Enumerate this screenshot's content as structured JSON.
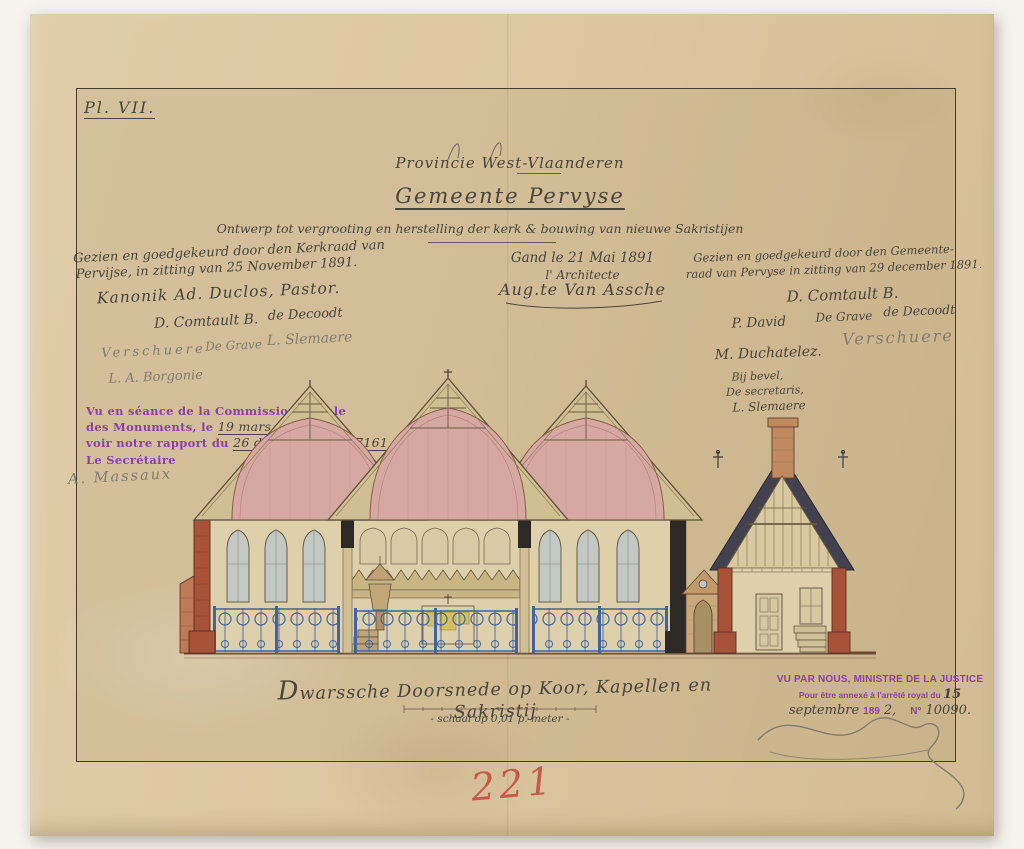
{
  "palette": {
    "bg": "#f6f4ef",
    "paper": "#dcc7a1",
    "frame": "#453c30",
    "ink": "#4a443a",
    "pencil": "#837b6d",
    "purple": "#8b3fa8",
    "red": "#c6483c",
    "brick": "#a9523a",
    "brick2": "#bc7a55",
    "slate": "#42414f",
    "blue": "#3f63a4",
    "pink": "#d6a8a2",
    "timber": "#d0bf92",
    "cream": "#ddd0ab",
    "glass": "#c2c8c4",
    "gold": "#d2be52",
    "dark": "#2d2a25",
    "line": "#5f5138",
    "ground": "#6b4a32"
  },
  "plate": {
    "label": "Pl. VII."
  },
  "header": {
    "province": "Provincie West-Vlaanderen",
    "gemeente": "Gemeente Pervyse",
    "subtitle": "Ontwerp tot vergrooting en herstelling der kerk & bouwing van nieuwe Sakristijen"
  },
  "church_approval": {
    "line1": "Gezien en goedgekeurd door den Kerkraad van",
    "line2": "Pervijse, in zitting van 25 November 1891.",
    "pastor": "Kanonik Ad. Duclos, Pastor.",
    "sig_row1a": "D. Comtault B.",
    "sig_row1b": "de Decoodt",
    "sig_row2a": "Verschuere",
    "sig_row2b": "De Grave",
    "sig_row2c": "L. Slemaere",
    "sig_row3": "L. A. Borgonie"
  },
  "architect": {
    "date": "Gand le 21 Mai 1891",
    "role": "l' Architecte",
    "signature": "Aug.te Van Assche"
  },
  "council_approval": {
    "line1": "Gezien en goedgekeurd door den Gemeente-",
    "line2": "raad van Pervyse in zitting van 29 december 1891.",
    "sig1": "D. Comtault B.",
    "sig_row2a": "P. David",
    "sig_row2b": "De Grave",
    "sig_row2c": "de Decoodt",
    "sig3": "Verschuere",
    "sig4": "M. Duchatelez.",
    "by_order": "Bij bevel,",
    "secretary": "De secretaris,",
    "sig5": "L. Slemaere"
  },
  "commission_stamp": {
    "line1": "Vu en séance de la Commission Royale",
    "line2_label": "des Monuments, le",
    "line2_fill": "19 mars 1892",
    "line3_label": "voir notre rapport du",
    "line3_fill": "26 de ce mois, N° 7161",
    "secretary_label": "Le Secrétaire",
    "president_label": "Le Président,",
    "secretary_sig": "A. Massaux"
  },
  "caption": {
    "title": "Dwarssche Doorsnede op Koor, Kapellen en Sakristij",
    "scale": "- schaal op 0,01 p. meter -"
  },
  "justice_stamp": {
    "line1": "VU PAR NOUS, MINISTRE DE LA JUSTICE",
    "line2_label": "Pour être annexé à l'arrêté royal du",
    "line2_fill": "15",
    "line3_fill_month": "septembre",
    "line3_year_label": "189",
    "line3_fill_year": "2,",
    "line3_no_label": "N°",
    "line3_fill_no": "10090."
  },
  "page_number": "221"
}
